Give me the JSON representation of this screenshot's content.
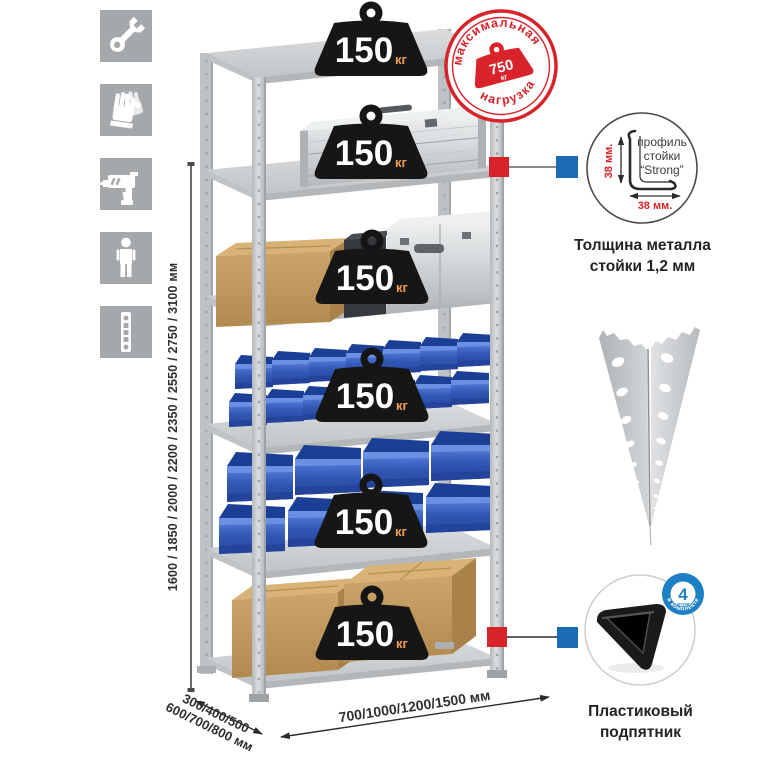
{
  "sidebar": {
    "tiles": [
      {
        "icon": "wrench-icon"
      },
      {
        "icon": "gloves-icon"
      },
      {
        "icon": "drill-icon"
      },
      {
        "icon": "person-icon"
      },
      {
        "icon": "rack-profile-icon"
      }
    ]
  },
  "dimensions": {
    "height_label": "1600 / 1850 / 2000 / 2200 / 2350 / 2550 / 2750 / 3100 мм",
    "depth_label_line1": "300/400/500",
    "depth_label_line2": "600/700/800 мм",
    "width_label": "700/1000/1200/1500 мм"
  },
  "max_load_stamp": {
    "arc_top": "максимальная",
    "arc_bottom": "нагрузка",
    "value": "750",
    "unit": "кг",
    "color": "#d8232a"
  },
  "shelf_badges": [
    {
      "value": "150",
      "unit": "кг"
    },
    {
      "value": "150",
      "unit": "кг"
    },
    {
      "value": "150",
      "unit": "кг"
    },
    {
      "value": "150",
      "unit": "кг"
    },
    {
      "value": "150",
      "unit": "кг"
    },
    {
      "value": "150",
      "unit": "кг"
    }
  ],
  "profile_callout": {
    "labels": [
      "профиль",
      "стойки",
      "“Strong”"
    ],
    "dim_vertical": "38 мм.",
    "dim_horizontal": "38 мм.",
    "caption": [
      "Толщина металла",
      "стойки 1,2 мм"
    ]
  },
  "foot_callout": {
    "badge_value": "4",
    "badge_small": "штуки",
    "badge_arc": "в комплекте",
    "caption": [
      "Пластиковый",
      "подпятник"
    ]
  },
  "colors": {
    "marker_red": "#d8232a",
    "marker_blue": "#1b6cb5",
    "bin_blue": "#3a66cc",
    "metal_gray": "#c9ccce",
    "badge_black": "#161616",
    "badge_unit_orange": "#f09c55"
  }
}
